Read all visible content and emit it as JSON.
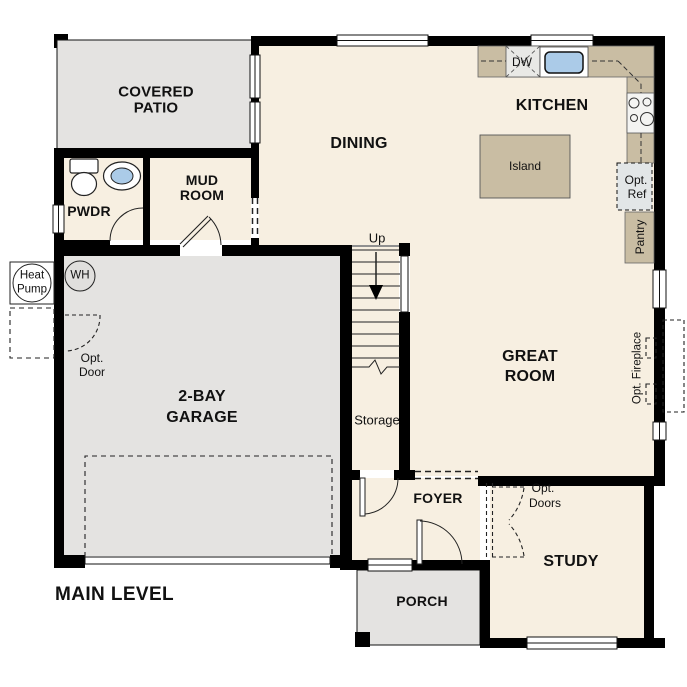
{
  "title": "Main Level floor plan",
  "level_label": "MAIN LEVEL",
  "colors": {
    "wall": "#000000",
    "floor": "#f7efe1",
    "outdoor_concrete": "#e4e3e1",
    "counter_tan": "#c9bda3",
    "sink_blue": "#abcbe8",
    "appliance_gray": "#e2e6e7",
    "text": "#111111"
  },
  "labels": {
    "covered_patio_1": "COVERED",
    "covered_patio_2": "PATIO",
    "pwdr": "PWDR",
    "mud_1": "MUD",
    "mud_2": "ROOM",
    "dining": "DINING",
    "kitchen": "KITCHEN",
    "island": "Island",
    "dw": "DW",
    "opt_ref_1": "Opt.",
    "opt_ref_2": "Ref",
    "pantry": "Pantry",
    "up": "Up",
    "storage": "Storage",
    "great_1": "GREAT",
    "great_2": "ROOM",
    "opt_fireplace": "Opt. Fireplace",
    "garage_1": "2-BAY",
    "garage_2": "GARAGE",
    "heat_1": "Heat",
    "heat_2": "Pump",
    "wh": "WH",
    "opt_door_1": "Opt.",
    "opt_door_2": "Door",
    "foyer": "FOYER",
    "opt_doors_1": "Opt.",
    "opt_doors_2": "Doors",
    "study": "STUDY",
    "porch": "PORCH",
    "main_level": "MAIN LEVEL"
  }
}
